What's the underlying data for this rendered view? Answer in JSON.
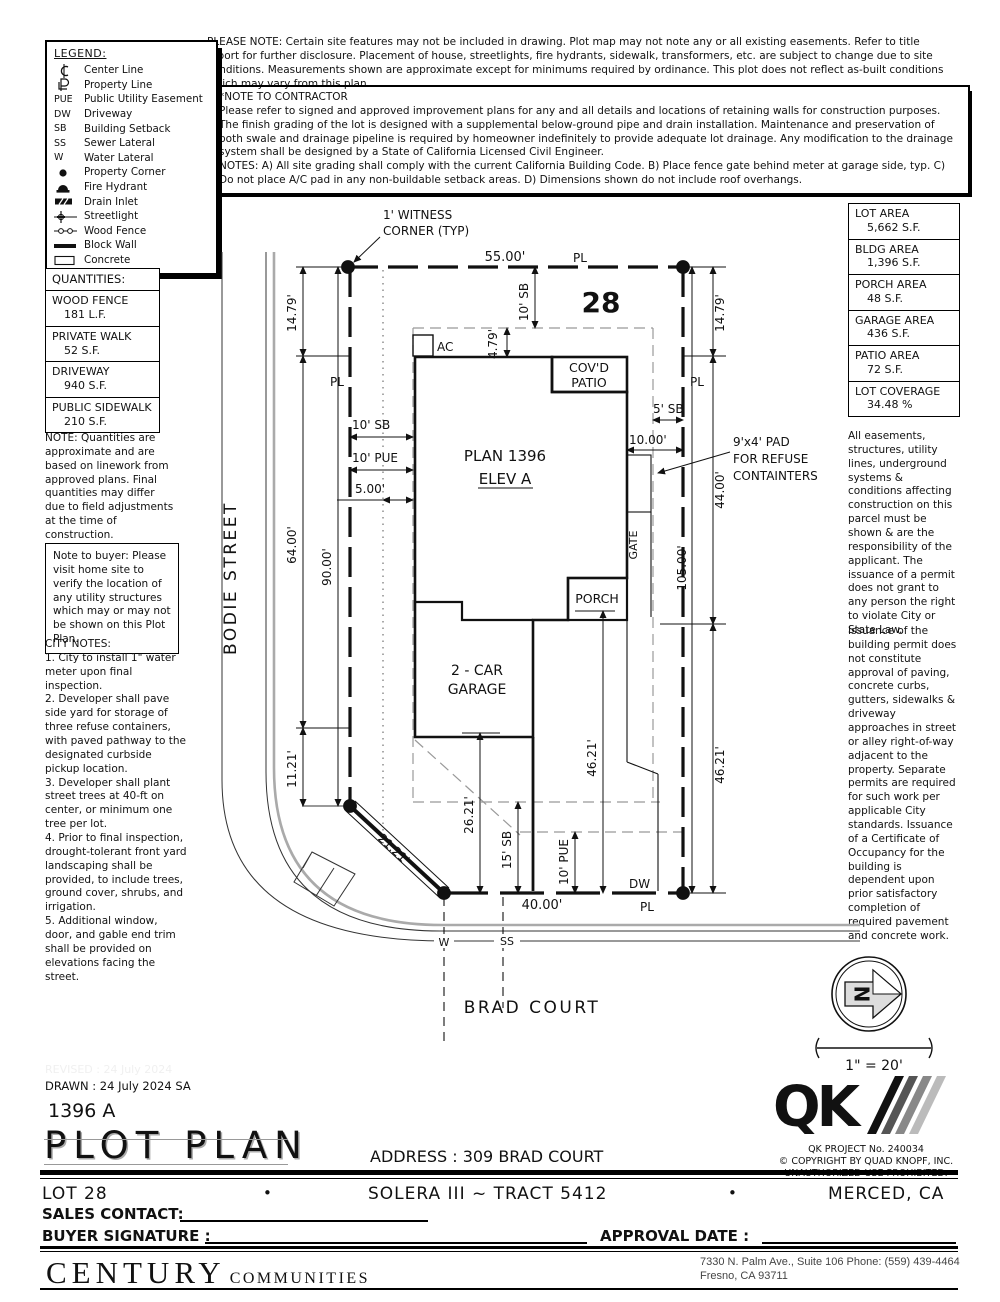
{
  "legend": {
    "title": "LEGEND:",
    "items": [
      {
        "symbol": "",
        "label": "Center Line"
      },
      {
        "symbol": "",
        "label": "Property Line"
      },
      {
        "symbol": "PUE",
        "label": "Public Utility Easement"
      },
      {
        "symbol": "DW",
        "label": "Driveway"
      },
      {
        "symbol": "SB",
        "label": "Building Setback"
      },
      {
        "symbol": "SS",
        "label": "Sewer Lateral"
      },
      {
        "symbol": "W",
        "label": "Water Lateral"
      },
      {
        "symbol": "",
        "label": "Property Corner"
      },
      {
        "symbol": "",
        "label": "Fire Hydrant"
      },
      {
        "symbol": "",
        "label": "Drain Inlet"
      },
      {
        "symbol": "",
        "label": "Streetlight"
      },
      {
        "symbol": "",
        "label": "Wood Fence"
      },
      {
        "symbol": "",
        "label": "Block Wall"
      },
      {
        "symbol": "",
        "label": "Concrete"
      }
    ]
  },
  "notes": {
    "please_note": "PLEASE NOTE:  Certain site features may not be included in drawing.  Plot map may not note any or all existing easements. Refer to title report for further disclosure.  Placement of house, streetlights, fire hydrants, sidewalk, transformers, etc. are subject to change due to site conditions.  Measurements shown are approximate except for minimums required by ordinance.  This plot does not reflect as-built conditions which may vary from this plan.",
    "contractor": "*NOTE TO CONTRACTOR\nPlease refer to signed and approved improvement plans for any and all details and locations of retaining walls for construction purposes.\nThe finish grading of the lot is designed with a supplemental below-ground pipe and drain installation.  Maintenance and preservation of both swale and drainage pipeline is required by homeowner indefinitely to provide adequate lot drainage.  Any modification to the drainage system shall be designed by a State of California Licensed Civil Engineer.\nNOTES:  A) All site grading shall comply with the current California Building Code.  B) Place fence gate behind meter at garage side, typ.  C) Do not place A/C pad in any non-buildable setback areas.  D) Dimensions shown do not include roof overhangs."
  },
  "quantities": {
    "title": "QUANTITIES:",
    "rows": [
      {
        "name": "WOOD FENCE",
        "value": "181 L.F."
      },
      {
        "name": "PRIVATE WALK",
        "value": "52 S.F."
      },
      {
        "name": "DRIVEWAY",
        "value": "940 S.F."
      },
      {
        "name": "PUBLIC SIDEWALK",
        "value": "210 S.F."
      }
    ],
    "note": "NOTE: Quantities are approximate and are based on linework from approved plans.  Final quantities may differ due to field adjustments at the time of construction."
  },
  "buyer_note": "Note to buyer: Please visit home site to verify the location of any utility structures which may or may not be shown on this Plot Plan.",
  "city_notes": "CITY NOTES:\n1. City to install 1\" water meter upon final inspection.\n2. Developer shall pave side yard for storage of three refuse containers, with paved pathway to the designated curbside pickup location.\n3. Developer shall plant street trees at 40-ft on center, or minimum one tree per lot.\n4. Prior to final inspection, drought-tolerant front yard landscaping shall be provided, to include trees, ground cover, shrubs, and irrigation.\n5. Additional window, door, and gable end trim shall be provided on elevations facing the street.",
  "areas": {
    "rows": [
      {
        "name": "LOT AREA",
        "value": "5,662 S.F."
      },
      {
        "name": "BLDG AREA",
        "value": "1,396 S.F."
      },
      {
        "name": "PORCH AREA",
        "value": "48 S.F."
      },
      {
        "name": "GARAGE AREA",
        "value": "436 S.F."
      },
      {
        "name": "PATIO AREA",
        "value": "72 S.F."
      },
      {
        "name": "LOT COVERAGE",
        "value": "34.48 %"
      }
    ]
  },
  "right_notes": {
    "p1": "All easements, structures, utility lines, underground systems & conditions affecting construction on this parcel must be shown & are the responsibility of the applicant. The issuance of a permit does not grant to any person the right to violate City or State Law.",
    "p2": "Issuance of the building permit does not constitute approval of paving, concrete curbs, gutters, sidewalks & driveway approaches in street or alley right-of-way adjacent to the property. Separate permits are required for such work per applicable City standards. Issuance of a Certificate of Occupancy for the building is dependent upon prior satisfactory completion of required pavement and concrete work."
  },
  "plot": {
    "labels": {
      "witness1": "1' WITNESS",
      "witness2": "CORNER (TYP)",
      "dim_55": "55.00'",
      "pl": "PL",
      "lot_number": "28",
      "sb10": "10' SB",
      "dim_479": "4.79'",
      "dim_1479": "14.79'",
      "ac": "AC",
      "covd1": "COV'D",
      "covd2": "PATIO",
      "sb5": "5' SB",
      "dim_10": "10.00'",
      "pad1": "9'x4' PAD",
      "pad2": "FOR REFUSE",
      "pad3": "CONTAINTERS",
      "plan1": "PLAN 1396",
      "plan2": "ELEV A",
      "pue10": "10' PUE",
      "dim_5": "5.00'",
      "dim_64": "64.00'",
      "dim_90": "90.00'",
      "dim_44": "44.00'",
      "dim_105": "105.00'",
      "gate": "GATE",
      "porch": "PORCH",
      "garage1": "2 - CAR",
      "garage2": "GARAGE",
      "dim_1121": "11.21'",
      "dim_2121": "21.21'",
      "dim_2621": "26.21'",
      "sb15": "15' SB",
      "dim_4621": "46.21'",
      "dim_40": "40.00'",
      "dw": "DW",
      "w": "W",
      "ss": "SS",
      "brad": "BRAD COURT",
      "bodie": "BODIE STREET"
    }
  },
  "north": {
    "letter": "N",
    "scale": "1\" = 20'"
  },
  "qk": {
    "project": "QK PROJECT No. 240034",
    "copyright": "©  COPYRIGHT BY QUAD KNOPF, INC.",
    "unauthorized": "UNAUTHORIZED USE PROHIBITED."
  },
  "titleblock": {
    "revised": "REVISED :  24 July 2024",
    "drawn": "DRAWN :  24 July 2024  SA",
    "plan_code": "1396  A",
    "title": "PLOT PLAN",
    "address": "ADDRESS :  309 BRAD COURT",
    "lot": "LOT 28",
    "dot": "•",
    "tract": "SOLERA III ~ TRACT 5412",
    "city": "MERCED, CA",
    "sales_label": "SALES CONTACT:",
    "buyer_label": "BUYER SIGNATURE :",
    "approval_label": "APPROVAL DATE :",
    "brand": "CENTURY",
    "brand2": "COMMUNITIES",
    "office1": "7330 N. Palm Ave., Suite 106   Phone:  (559) 439-4464",
    "office2": "Fresno, CA  93711"
  }
}
